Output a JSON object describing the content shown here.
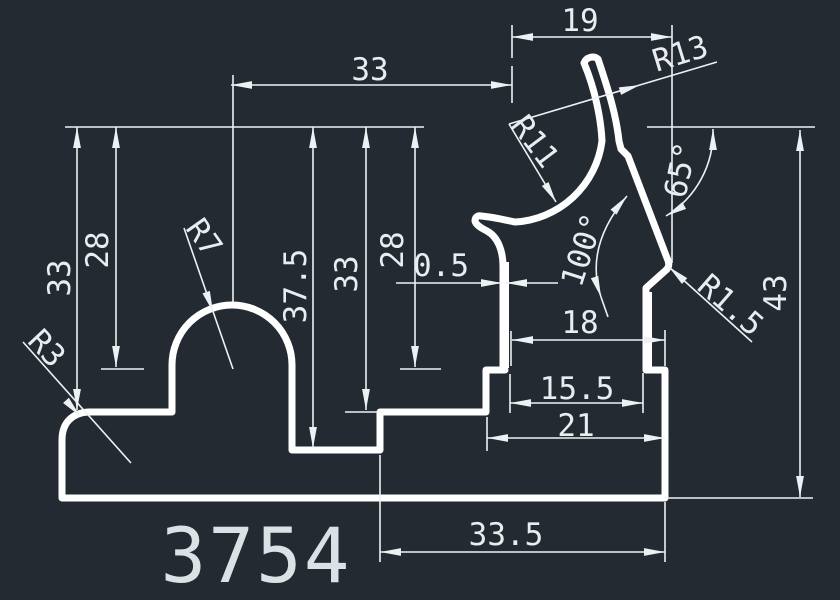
{
  "app": {
    "view": "cad-drawing-canvas",
    "background_color": "#242a32",
    "profile_line_color": "#ffffff",
    "dimension_color": "#edf1f4"
  },
  "drawing": {
    "part_number": "3754",
    "dims": {
      "v33_left": "33",
      "v28_left": "28",
      "v37_5": "37.5",
      "v33_mid": "33",
      "v28_mid": "28",
      "v43": "43",
      "h33_top": "33",
      "h19": "19",
      "h0_5": "0.5",
      "h18": "18",
      "h15_5": "15.5",
      "h21": "21",
      "h33_5": "33.5",
      "r3": "R3",
      "r7": "R7",
      "r11": "R11",
      "r13": "R13",
      "r1_5": "R1.5",
      "a65": "65°",
      "a100": "100°"
    }
  }
}
